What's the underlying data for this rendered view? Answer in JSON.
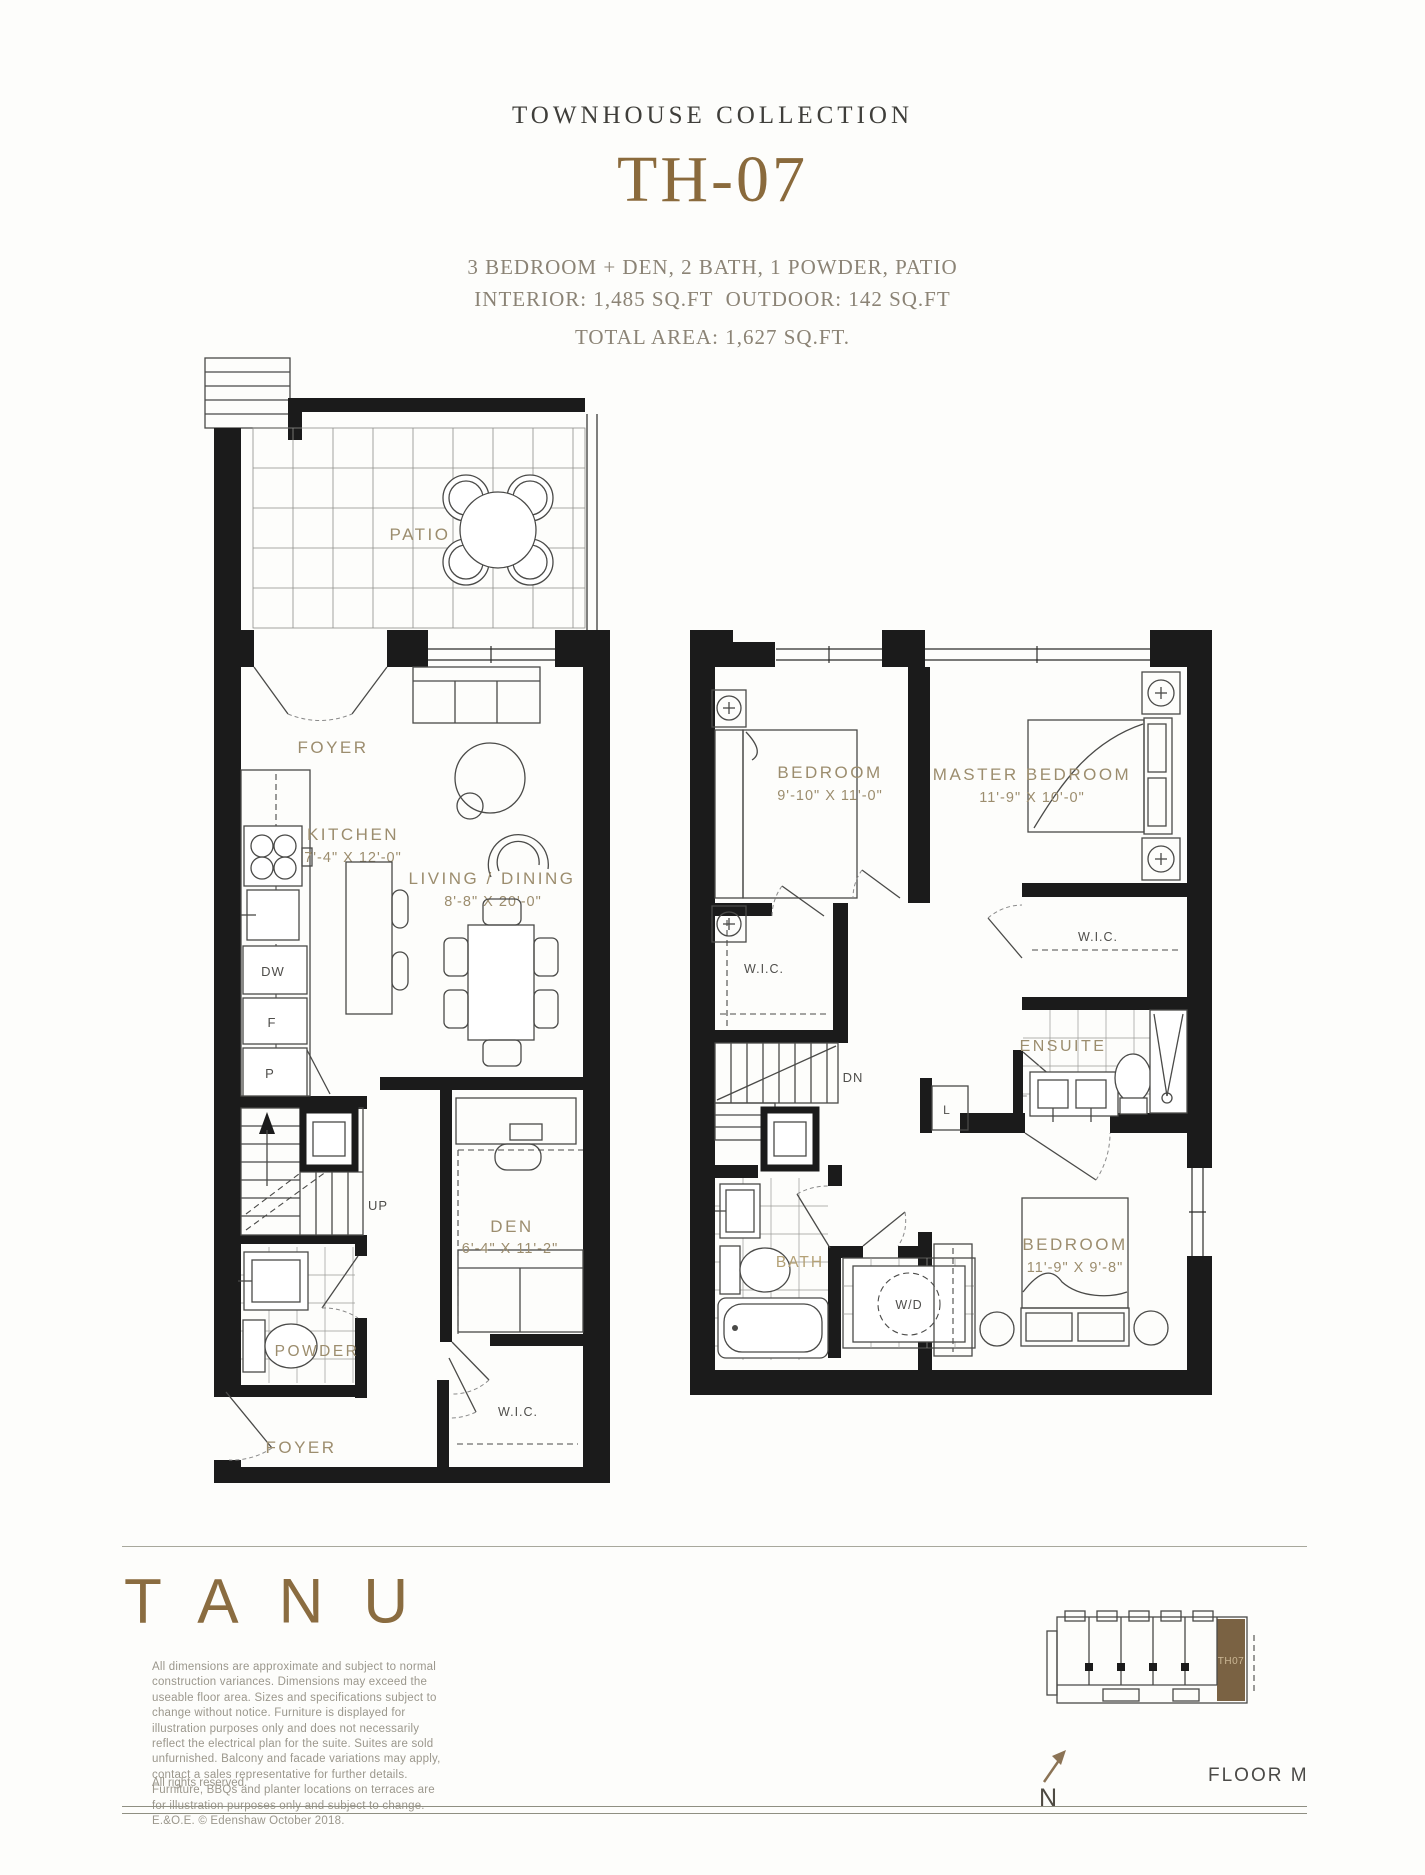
{
  "header": {
    "collection": "TOWNHOUSE COLLECTION",
    "unit": "TH-07",
    "features": "3 BEDROOM + DEN, 2 BATH, 1 POWDER, PATIO",
    "areas": "INTERIOR: 1,485 SQ.FT  OUTDOOR: 142 SQ.FT",
    "total": "TOTAL AREA: 1,627 SQ.FT."
  },
  "plan1": {
    "patio": "PATIO",
    "foyer_upper": "FOYER",
    "kitchen": "KITCHEN",
    "kitchen_dim": "7'-4\" X 12'-0\"",
    "living": "LIVING / DINING",
    "living_dim": "8'-8\" X 20'-0\"",
    "dw": "DW",
    "fridge": "F",
    "pantry": "P",
    "up": "UP",
    "powder": "POWDER",
    "den": "DEN",
    "den_dim": "6'-4\" X 11'-2\"",
    "wic": "W.I.C.",
    "foyer_lower": "FOYER"
  },
  "plan2": {
    "bedroom1": "BEDROOM",
    "bedroom1_dim": "9'-10\" X 11'-0\"",
    "master": "MASTER BEDROOM",
    "master_dim": "11'-9\" X 10'-0\"",
    "wic_left": "W.I.C.",
    "wic_right": "W.I.C.",
    "ensuite": "ENSUITE",
    "dn": "DN",
    "linen": "L",
    "bath": "BATH",
    "wd": "W/D",
    "bedroom2": "BEDROOM",
    "bedroom2_dim": "11'-9\" X 9'-8\""
  },
  "footer": {
    "logo": "TANU",
    "disclaimer": "All dimensions are approximate and subject to normal construction variances. Dimensions may exceed the useable floor area. Sizes and specifications subject to change without notice. Furniture is displayed for illustration purposes only and does not necessarily reflect the electrical plan for the suite. Suites are sold unfurnished. Balcony and facade variations may apply, contact a sales representative for further details. Furniture, BBQs and planter locations on terraces are for illustration purposes only and subject to change. E.&O.E. © Edenshaw October 2018.",
    "rights": "All rights reserved.",
    "keyplan_unit": "TH07",
    "north": "N",
    "floor_label": "FLOOR M"
  },
  "colors": {
    "accent_gold": "#8a6a3c",
    "room_label": "#9c8d6e",
    "keyplan_highlight": "#7a6243",
    "text_dark": "#3f3e3a"
  }
}
